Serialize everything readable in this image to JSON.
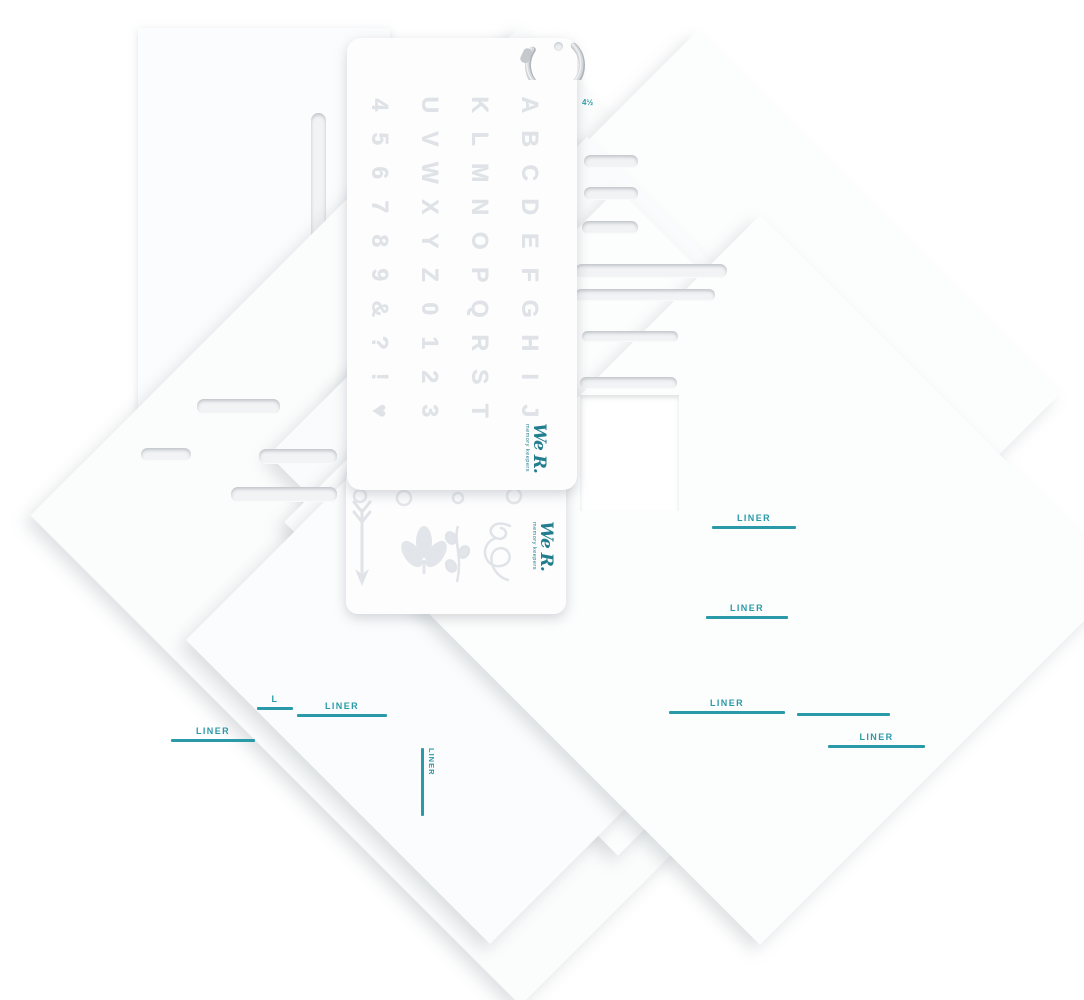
{
  "brand": {
    "title": "We R.",
    "subtitle": "memory keepers"
  },
  "size_label": "4½",
  "stencil_columns": [
    "ABCDEFGHIJ",
    "KLMNOPQRST",
    "UVWXYZ0123",
    "456789&?!♥"
  ],
  "shape_icons": [
    "arrow-icon",
    "leaf-sprig-icon",
    "vine-icon",
    "flourish-icon"
  ],
  "liner_labels": [
    {
      "text": "LINER",
      "x": 712,
      "y": 513,
      "w": 84,
      "orient": "h"
    },
    {
      "text": "LINER",
      "x": 706,
      "y": 603,
      "w": 82,
      "orient": "h"
    },
    {
      "text": "LINER",
      "x": 669,
      "y": 698,
      "w": 116,
      "orient": "h"
    },
    {
      "text": "",
      "x": 797,
      "y": 700,
      "w": 93,
      "orient": "h"
    },
    {
      "text": "LINER",
      "x": 828,
      "y": 732,
      "w": 97,
      "orient": "h"
    },
    {
      "text": "L",
      "x": 257,
      "y": 694,
      "w": 36,
      "orient": "h"
    },
    {
      "text": "LINER",
      "x": 297,
      "y": 701,
      "w": 90,
      "orient": "h"
    },
    {
      "text": "LINER",
      "x": 171,
      "y": 726,
      "w": 84,
      "orient": "h"
    },
    {
      "text": "LINER",
      "x": 421,
      "y": 748,
      "h": 68,
      "orient": "v"
    }
  ],
  "colors": {
    "liner_teal": "#2a9aa8",
    "logo_teal": "#227e8f"
  }
}
